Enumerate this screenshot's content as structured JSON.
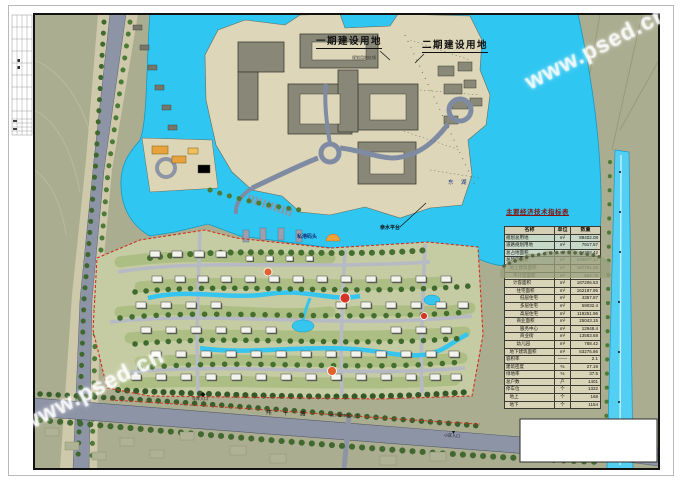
{
  "watermarks": [
    {
      "text": "www.psed.cn"
    },
    {
      "text": "www.psed.cn"
    }
  ],
  "map_labels": {
    "phase1": "一期建设用地",
    "phase2": "二期建设用地",
    "red_line_note": "规划用地红线",
    "dock": "私港码头",
    "waterfront": "亲水平台",
    "lake": "东 湖",
    "road_bottom": "纬 十 路",
    "garage_entry": "车库入口",
    "garage_gateway": "地下车库出入口",
    "community_entry": "小区入口"
  },
  "indicators_table": {
    "title": "主要经济技术指标表",
    "headers": [
      "名称",
      "单位",
      "数量"
    ],
    "rows": [
      {
        "name": "规划总用地",
        "unit": "m²",
        "qty": "89402.08",
        "indent": 0
      },
      {
        "name": "道路规划用地",
        "unit": "m²",
        "qty": "7917.57",
        "indent": 0
      },
      {
        "name": "总占地面积",
        "unit": "m²",
        "qty": "34308.42",
        "indent": 0
      },
      {
        "name": "总建筑面积",
        "unit": "m²",
        "qty": "240977.14",
        "indent": 0
      },
      {
        "name": "地上建筑面积",
        "unit": "m²",
        "qty": "187701.28",
        "indent": 1
      },
      {
        "name": "不计容面积",
        "unit": "m²",
        "qty": "562.78",
        "indent": 2
      },
      {
        "name": "计容面积",
        "unit": "m²",
        "qty": "187206.53",
        "indent": 2
      },
      {
        "name": "住宅面积",
        "unit": "m²",
        "qty": "162187.95",
        "indent": 3
      },
      {
        "name": "低层住宅",
        "unit": "m²",
        "qty": "4357.87",
        "indent": 4
      },
      {
        "name": "多层住宅",
        "unit": "m²",
        "qty": "59032.4",
        "indent": 4
      },
      {
        "name": "高层住宅",
        "unit": "m²",
        "qty": "119251.96",
        "indent": 4
      },
      {
        "name": "商业面积",
        "unit": "m²",
        "qty": "25043.15",
        "indent": 3
      },
      {
        "name": "服务中心",
        "unit": "m²",
        "qty": "12948.4",
        "indent": 4
      },
      {
        "name": "商业街",
        "unit": "m²",
        "qty": "13583.68",
        "indent": 4
      },
      {
        "name": "幼儿园",
        "unit": "m²",
        "qty": "788.42",
        "indent": 3
      },
      {
        "name": "地下建筑面积",
        "unit": "m²",
        "qty": "53275.86",
        "indent": 1
      },
      {
        "name": "容积率",
        "unit": "——",
        "qty": "2.1",
        "indent": 0
      },
      {
        "name": "建筑密度",
        "unit": "%",
        "qty": "27.19",
        "indent": 0
      },
      {
        "name": "绿地率",
        "unit": "%",
        "qty": "37.5",
        "indent": 0
      },
      {
        "name": "总户数",
        "unit": "户",
        "qty": "1401",
        "indent": 0
      },
      {
        "name": "停车位",
        "unit": "个",
        "qty": "1322",
        "indent": 0
      },
      {
        "name": "地上",
        "unit": "个",
        "qty": "168",
        "indent": 1
      },
      {
        "name": "地下",
        "unit": "个",
        "qty": "1154",
        "indent": 1
      }
    ]
  },
  "colors": {
    "lake": "#2fc6f1",
    "canal": "#54cff4",
    "terrain": "#aaad8f",
    "land": "#ddd6b8",
    "road": "#8d94a6",
    "residential_base": "#c5cba2",
    "boundary_red": "#d03020",
    "table_title": "#8a120c",
    "tree_green": "#3e6a2d",
    "accent_orange": "#e0622c"
  }
}
